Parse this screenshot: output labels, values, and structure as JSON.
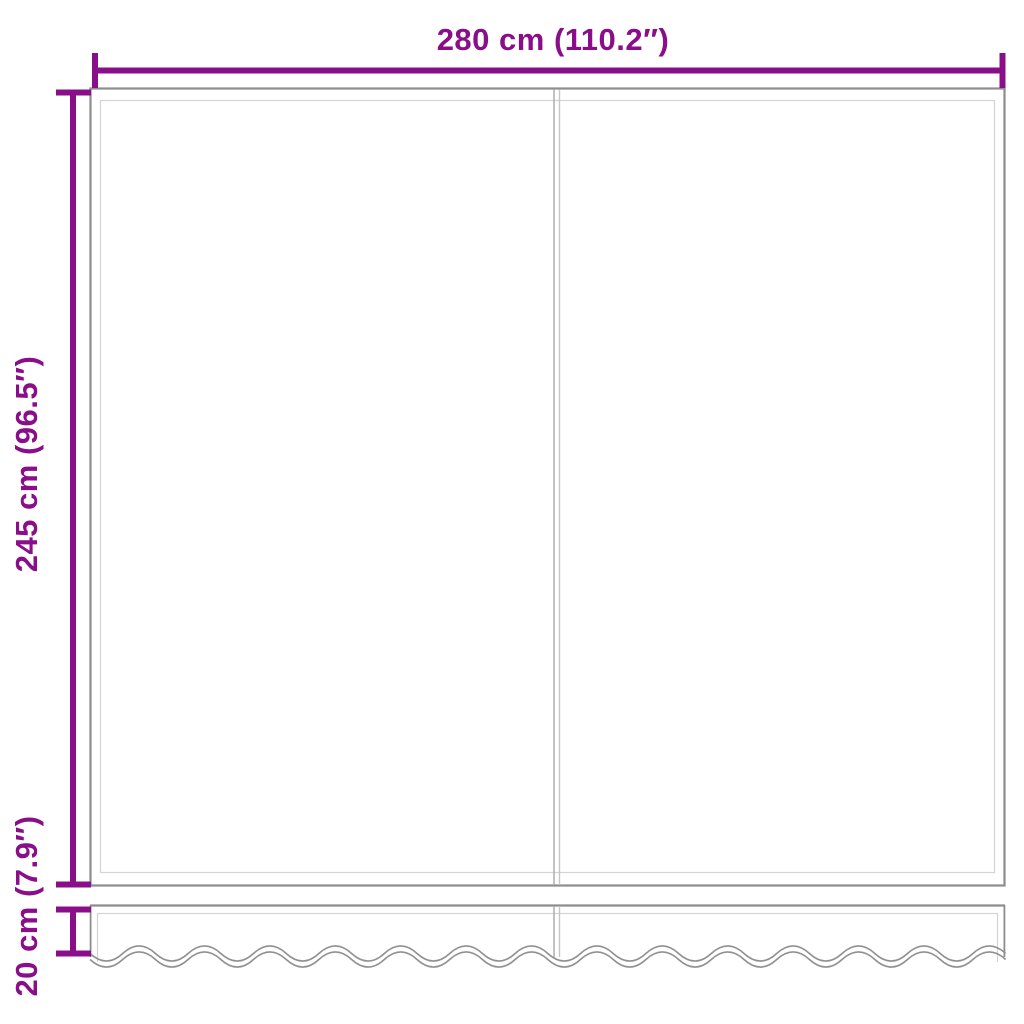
{
  "diagram": {
    "kind": "product-dimension-diagram",
    "labels": {
      "width": "280 cm (110.2″)",
      "height": "245 cm (96.5″)",
      "valance_height": "20 cm (7.9″)"
    },
    "colors": {
      "dimension": "#8A0E8A",
      "outline": "#8d8d8d",
      "outline_light": "#d4d4d4",
      "seam_dark": "#a8a8a8",
      "seam_light": "#c6c6c6",
      "wave": "#909090",
      "background": "#ffffff"
    }
  }
}
